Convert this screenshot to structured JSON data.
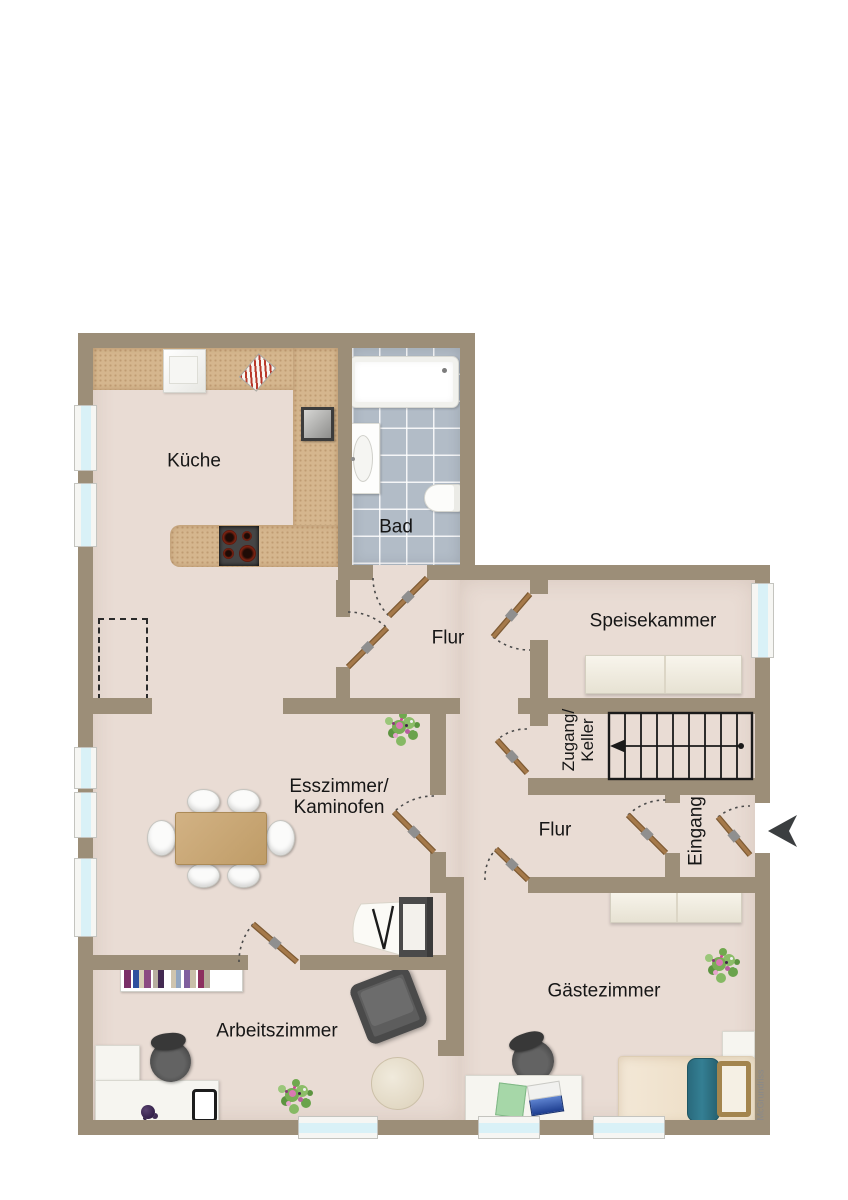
{
  "plan": {
    "watermark": "McGrundriss",
    "rooms": {
      "kueche": "Küche",
      "bad": "Bad",
      "flur_top": "Flur",
      "speisekammer": "Speisekammer",
      "zugang_line1": "Zugang/",
      "zugang_line2": "Keller",
      "esszimmer_line1": "Esszimmer/",
      "esszimmer_line2": "Kaminofen",
      "flur_bottom": "Flur",
      "eingang": "Eingang",
      "arbeitszimmer": "Arbeitszimmer",
      "gaestezimmer": "Gästezimmer"
    }
  },
  "theme": {
    "wall": "#9c8e78",
    "floor": "#e9dcd4",
    "counter": "#d5b68e",
    "tile": "#b2bcc7",
    "door": "#a5794a",
    "glass": "#d9f1f7",
    "table": "#c9a877",
    "blanket": "#2f7487",
    "stairline": "#1a1a1a",
    "arrow": "#3b3e40"
  }
}
